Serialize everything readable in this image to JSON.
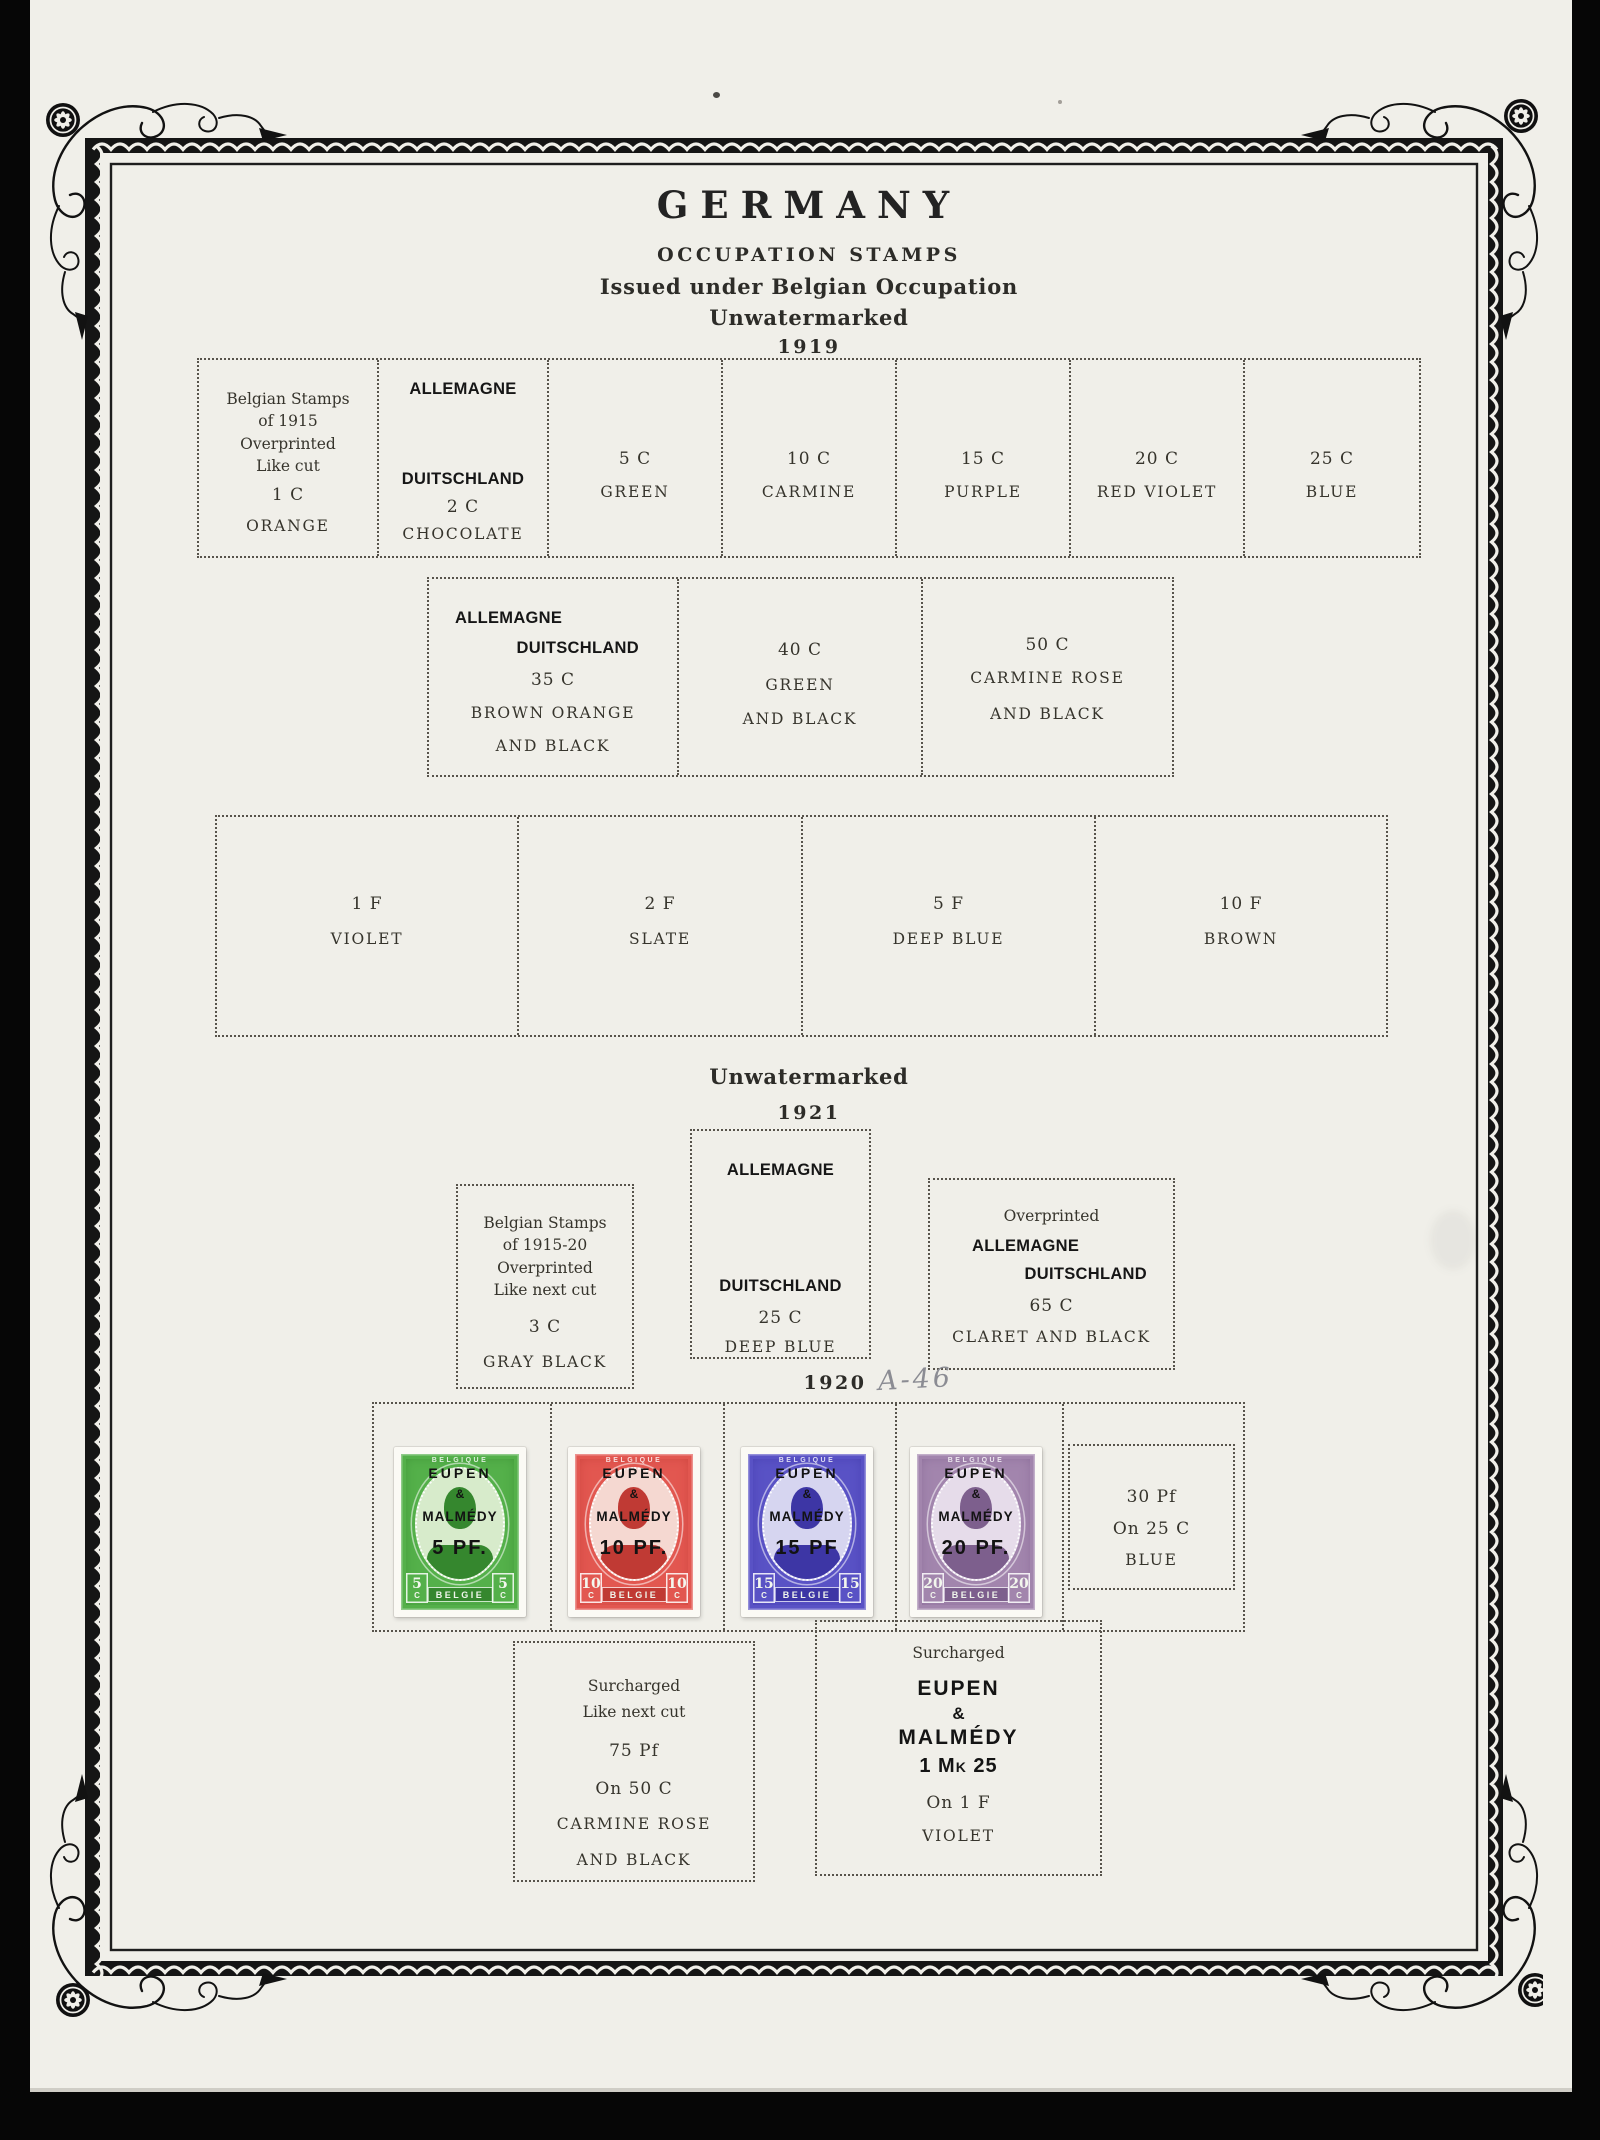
{
  "palette": {
    "page_bg": "#f0efe9",
    "border_ink": "#121212",
    "dash": "#57534b",
    "pencil": "#8b8c93"
  },
  "header": {
    "title": "GERMANY",
    "subtitle": "OCCUPATION STAMPS",
    "issued_line": "Issued under Belgian Occupation",
    "watermark_line": "Unwatermarked",
    "year": "1919"
  },
  "section_1921": {
    "watermark_line": "Unwatermarked",
    "year": "1921"
  },
  "section_1920": {
    "year": "1920",
    "handwritten_note": "A-46"
  },
  "row_1919_small": {
    "cells": [
      {
        "lines": [
          "Belgian Stamps",
          "of 1915",
          "Overprinted",
          "Like cut"
        ],
        "value": "1 C",
        "color": "ORANGE"
      },
      {
        "overprint_top": "ALLEMAGNE",
        "overprint_bottom": "DUITSCHLAND",
        "value": "2 C",
        "color": "CHOCOLATE"
      },
      {
        "value": "5 C",
        "color": "GREEN"
      },
      {
        "value": "10 C",
        "color": "CARMINE"
      },
      {
        "value": "15 C",
        "color": "PURPLE"
      },
      {
        "value": "20 C",
        "color": "RED VIOLET"
      },
      {
        "value": "25 C",
        "color": "BLUE"
      }
    ]
  },
  "row_1919_medium": {
    "cells": [
      {
        "overprint_top": "ALLEMAGNE",
        "overprint_bottom": "DUITSCHLAND",
        "value": "35 C",
        "color1": "BROWN ORANGE",
        "color2": "AND BLACK"
      },
      {
        "value": "40 C",
        "color1": "GREEN",
        "color2": "AND BLACK"
      },
      {
        "value": "50 C",
        "color1": "CARMINE ROSE",
        "color2": "AND BLACK"
      }
    ]
  },
  "row_francs": {
    "cells": [
      {
        "value": "1 F",
        "color": "VIOLET"
      },
      {
        "value": "2 F",
        "color": "SLATE"
      },
      {
        "value": "5 F",
        "color": "DEEP BLUE"
      },
      {
        "value": "10 F",
        "color": "BROWN"
      }
    ]
  },
  "boxes_1921": {
    "left": {
      "lines": [
        "Belgian Stamps",
        "of 1915-20",
        "Overprinted",
        "Like next cut"
      ],
      "value": "3 C",
      "color": "GRAY BLACK"
    },
    "center": {
      "overprint_top": "ALLEMAGNE",
      "overprint_bottom": "DUITSCHLAND",
      "value": "25 C",
      "color": "DEEP BLUE"
    },
    "right": {
      "label": "Overprinted",
      "overprint_top": "ALLEMAGNE",
      "overprint_bottom": "DUITSCHLAND",
      "value": "65 C",
      "color": "CLARET AND BLACK"
    }
  },
  "stamps": [
    {
      "id": "5pf-green",
      "arc_text": "BELGIQUE",
      "overprint": [
        "EUPEN",
        "&",
        "MALMÉDY"
      ],
      "surcharge": "5 PF.",
      "denomination": "5",
      "denom_unit": "C",
      "country": "BELGIE",
      "main": "#54b04a",
      "pale": "#d7ebcb",
      "dark": "#35872e"
    },
    {
      "id": "10pf-red",
      "arc_text": "BELGIQUE",
      "overprint": [
        "EUPEN",
        "&",
        "MALMÉDY"
      ],
      "surcharge": "10 PF.",
      "denomination": "10",
      "denom_unit": "C",
      "country": "BELGIE",
      "main": "#e25750",
      "pale": "#f5d8d1",
      "dark": "#c03a34"
    },
    {
      "id": "15pf-blue",
      "arc_text": "BELGIQUE",
      "overprint": [
        "EUPEN",
        "&",
        "MALMÉDY"
      ],
      "surcharge": "15 PF",
      "denomination": "15",
      "denom_unit": "C",
      "country": "BELGIE",
      "main": "#5952c5",
      "pale": "#d6d5f0",
      "dark": "#3d36a5"
    },
    {
      "id": "20pf-lilac",
      "arc_text": "BELGIQUE",
      "overprint": [
        "EUPEN",
        "&",
        "MALMÉDY"
      ],
      "surcharge": "20 PF.",
      "denomination": "20",
      "denom_unit": "C",
      "country": "BELGIE",
      "main": "#a285ad",
      "pale": "#e6dcea",
      "dark": "#7d5f8d"
    }
  ],
  "box_30pf": {
    "lines": [
      "30 Pf",
      "On 25 C",
      "BLUE"
    ]
  },
  "box_75pf": {
    "lines": [
      "Surcharged",
      "Like next cut",
      "75 Pf",
      "On 50 C",
      "CARMINE ROSE",
      "AND BLACK"
    ]
  },
  "box_1mk": {
    "label": "Surcharged",
    "overprint": [
      "EUPEN",
      "&",
      "MALMÉDY"
    ],
    "surcharge": "1 Mk 25",
    "value": "On 1 F",
    "color": "VIOLET"
  }
}
